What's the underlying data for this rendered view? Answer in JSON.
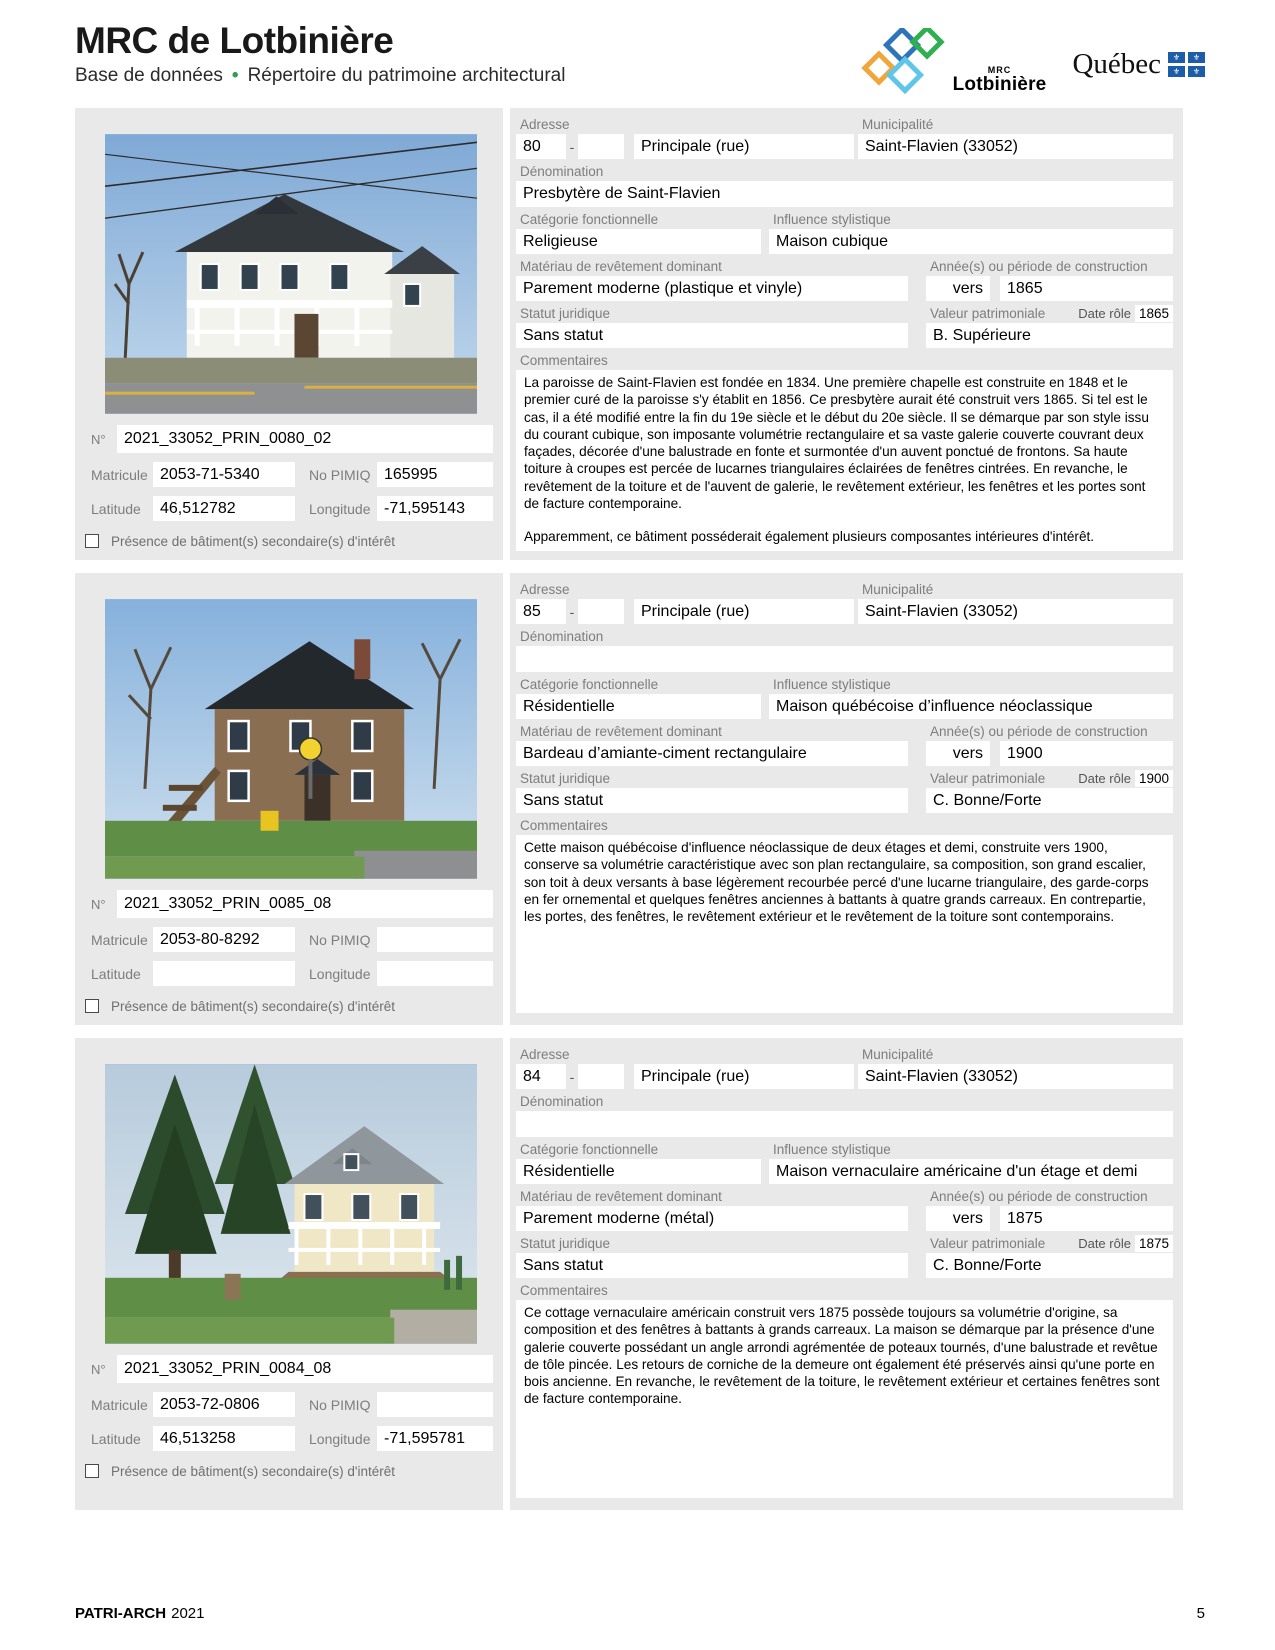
{
  "header": {
    "title": "MRC de Lotbinière",
    "subtitle_left": "Base de données",
    "subtitle_dot": "•",
    "subtitle_right": "Répertoire du patrimoine architectural",
    "mrc_logo_small": "MRC",
    "mrc_logo_big": "Lotbinière",
    "quebec_word": "Québec",
    "fleur_de_lis": "⚜"
  },
  "labels": {
    "adresse": "Adresse",
    "adresse_sep": "-",
    "municipalite": "Municipalité",
    "denomination": "Dénomination",
    "categorie": "Catégorie fonctionnelle",
    "influence": "Influence stylistique",
    "materiau": "Matériau de revêtement dominant",
    "annee": "Année(s) ou période de construction",
    "statut": "Statut juridique",
    "valeur": "Valeur patrimoniale",
    "date_role": "Date rôle",
    "commentaires": "Commentaires",
    "numero": "N°",
    "matricule": "Matricule",
    "no_pimiq": "No PIMIQ",
    "latitude": "Latitude",
    "longitude": "Longitude",
    "presence": "Présence de bâtiment(s) secondaire(s) d'intérêt"
  },
  "records": [
    {
      "adresse_no": "80",
      "adresse_no2": "",
      "rue": "Principale (rue)",
      "municipalite": "Saint-Flavien (33052)",
      "denomination": "Presbytère de Saint-Flavien",
      "categorie": "Religieuse",
      "influence": "Maison cubique",
      "materiau": "Parement moderne (plastique et vinyle)",
      "vers": "vers",
      "annee": "1865",
      "statut": "Sans statut",
      "valeur": "B. Supérieure",
      "date_role": "1865",
      "commentaires": "La paroisse de Saint-Flavien est fondée en 1834. Une première chapelle est construite en 1848 et le premier curé de la paroisse s'y établit en 1856. Ce presbytère aurait été construit vers 1865. Si tel est le cas, il a été modifié entre la fin du 19e siècle et le début du 20e siècle. Il se démarque par son style issu du courant cubique, son imposante volumétrie rectangulaire et sa vaste galerie couverte couvrant deux façades, décorée d'une balustrade en fonte et surmontée d'un auvent ponctué de frontons. Sa haute toiture à croupes est percée de lucarnes triangulaires éclairées de fenêtres cintrées. En revanche, le revêtement de la toiture et de l'auvent de galerie, le revêtement extérieur, les fenêtres et les portes sont de facture contemporaine.",
      "commentaires_2": "Apparemment, ce bâtiment posséderait également plusieurs composantes intérieures d'intérêt.",
      "numero": "2021_33052_PRIN_0080_02",
      "matricule": "2053-71-5340",
      "no_pimiq": "165995",
      "latitude": "46,512782",
      "longitude": "-71,595143"
    },
    {
      "adresse_no": "85",
      "adresse_no2": "",
      "rue": "Principale (rue)",
      "municipalite": "Saint-Flavien (33052)",
      "denomination": "",
      "categorie": "Résidentielle",
      "influence": "Maison québécoise d’influence néoclassique",
      "materiau": "Bardeau d’amiante-ciment rectangulaire",
      "vers": "vers",
      "annee": "1900",
      "statut": "Sans statut",
      "valeur": "C. Bonne/Forte",
      "date_role": "1900",
      "commentaires": "Cette maison québécoise d'influence néoclassique de deux étages et demi, construite vers 1900, conserve sa volumétrie caractéristique avec son plan rectangulaire, sa composition, son grand escalier, son toit à deux versants à base légèrement recourbée percé d'une lucarne triangulaire, des garde-corps en fer ornemental et quelques fenêtres anciennes à battants à quatre grands carreaux. En contrepartie, les portes, des fenêtres, le revêtement extérieur et le revêtement de la toiture sont contemporains.",
      "commentaires_2": "",
      "numero": "2021_33052_PRIN_0085_08",
      "matricule": "2053-80-8292",
      "no_pimiq": "",
      "latitude": "",
      "longitude": ""
    },
    {
      "adresse_no": "84",
      "adresse_no2": "",
      "rue": "Principale (rue)",
      "municipalite": "Saint-Flavien (33052)",
      "denomination": "",
      "categorie": "Résidentielle",
      "influence": "Maison vernaculaire américaine d'un étage et demi",
      "materiau": "Parement moderne (métal)",
      "vers": "vers",
      "annee": "1875",
      "statut": "Sans statut",
      "valeur": "C. Bonne/Forte",
      "date_role": "1875",
      "commentaires": "Ce cottage vernaculaire américain construit vers 1875 possède toujours sa volumétrie d'origine, sa composition et des fenêtres à battants à grands carreaux. La maison se démarque par la présence d'une galerie couverte possédant un angle arrondi agrémentée de poteaux tournés, d'une balustrade et revêtue de tôle pincée. Les retours de corniche de la demeure ont également été préservés ainsi qu'une porte en bois ancienne. En revanche, le revêtement de la toiture, le revêtement extérieur et certaines fenêtres sont de facture contemporaine.",
      "commentaires_2": "",
      "numero": "2021_33052_PRIN_0084_08",
      "matricule": "2053-72-0806",
      "no_pimiq": "",
      "latitude": "46,513258",
      "longitude": "-71,595781"
    }
  ],
  "footer": {
    "left_bold": "PATRI-ARCH",
    "left_year": "2021",
    "page": "5"
  }
}
